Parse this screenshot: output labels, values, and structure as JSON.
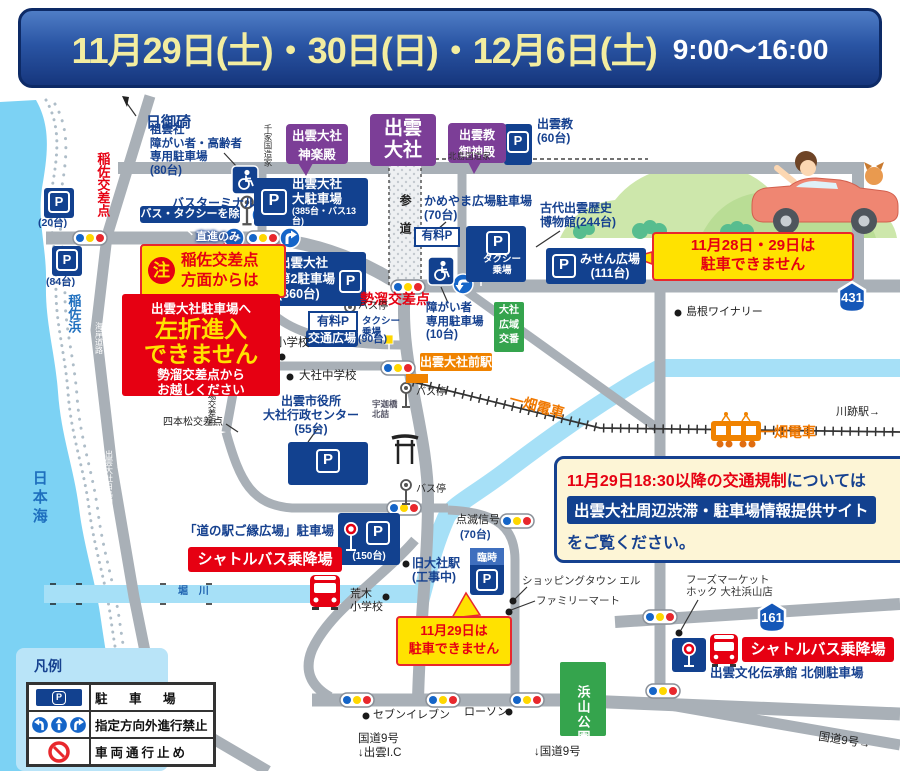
{
  "header": {
    "dates": "11月29日(土)・30日(日)・12月6日(土)",
    "time": "9:00〜16:00"
  },
  "geo": {
    "sea": "日本海",
    "beach": "稲佐浜",
    "cape": "日御碕",
    "coast_road": "海岸道路",
    "shiratori": "出雲大社白鳥線",
    "river": "堀 川",
    "sando": "参道",
    "ukabashi": "宇迦橋\n北詰"
  },
  "shrine": {
    "taisha": "出雲\n大社",
    "kagura": "出雲大社\n神楽殿",
    "goshinden": "出雲教\n御神殿",
    "senge": "千家国造家",
    "kitajima": "北島国造家"
  },
  "parking": {
    "p_letter": "P",
    "izumokyo": "出雲教\n(60台)",
    "soun": "祖雲社\n障がい者・高齢者\n専用駐車場\n(80台)",
    "main_name": "出雲大社\n大駐車場",
    "main_cap": "(385台・バス13台)",
    "p20": "(20台)",
    "p84": "(84台)",
    "second": "出雲大社\n第2駐車場\n(360台)",
    "kameyama": "かめやま広場駐車場\n(70台)",
    "paid1": "有料P",
    "paid2": "有料P",
    "kotsu": "交通広場",
    "kotsu_cap": "(90台)",
    "museum": "古代出雲歴史\n博物館(244台)",
    "misen": "みせん広場\n(111台)",
    "disabled10": "障がい者\n専用駐車場\n(10台)",
    "cityhall": "出雲市役所\n大社行政センター\n(55台)",
    "gouen": "「道の駅ご縁広場」駐車場",
    "p150": "(150台)",
    "rinji": "臨時",
    "p70": "(70台)",
    "tenmetsu": "点滅信号",
    "denshokan": "出雲文化伝承館 北側駐車場"
  },
  "warning": {
    "chui": "注",
    "inasa_from": "稲佐交差点\n方面からは",
    "to_lot": "出雲大社駐車場へ",
    "no_left": "左折進入\nできません",
    "from_seidamari": "勢溜交差点から\nお越しください",
    "nopark2829": "11月28日・29日は\n駐車できません",
    "nopark29": "11月29日は\n駐車できません"
  },
  "notice": {
    "l1r": "11月29日18:30以降の交通規制",
    "l1b": "については",
    "site": "出雲大社周辺渋滞・駐車場情報提供サイト",
    "l2": "をご覧ください。"
  },
  "shuttle": {
    "label": "シャトルバス乗降場"
  },
  "transit": {
    "station": "出雲大社前駅",
    "ichibata": "一畑電車",
    "kawato": "川跡駅→",
    "terminal": "バスターミナル",
    "busstop": "バス停",
    "taxi": "タクシー\n乗場",
    "except_bus": "バス・タクシーを除く",
    "straight": "直進のみ"
  },
  "cross": {
    "inasa": "稲佐交差点",
    "seidamari": "勢溜交差点",
    "miyauchi": "宮内交差点",
    "yotsukado": "四ツ角",
    "ichiba": "市場交差点",
    "yotsumatsu": "四本松交差点"
  },
  "poi": {
    "koban": "大社\n広域\n交番",
    "elem": "大社小学校",
    "jhs": "大社中学校",
    "winery": "島根ワイナリー",
    "old_st": "旧大社駅\n(工事中)",
    "shopping": "ショッピングタウン エル",
    "famima": "ファミリーマート",
    "seven": "セブンイレブン",
    "lawson": "ローソン",
    "hoku": "フーズマーケット\nホック 大社浜山店",
    "araki": "荒木\n小学校",
    "hamayama": "浜山公園",
    "r9ic": "国道9号\n↓出雲I.C",
    "r9down": "↓国道9号",
    "r9right": "国道9号→"
  },
  "route": {
    "r431": "431",
    "r161": "161"
  },
  "legend": {
    "title": "凡例",
    "parking": "駐 車 場",
    "direction": "指定方向外進行禁止",
    "closed": "車両通行止め"
  }
}
